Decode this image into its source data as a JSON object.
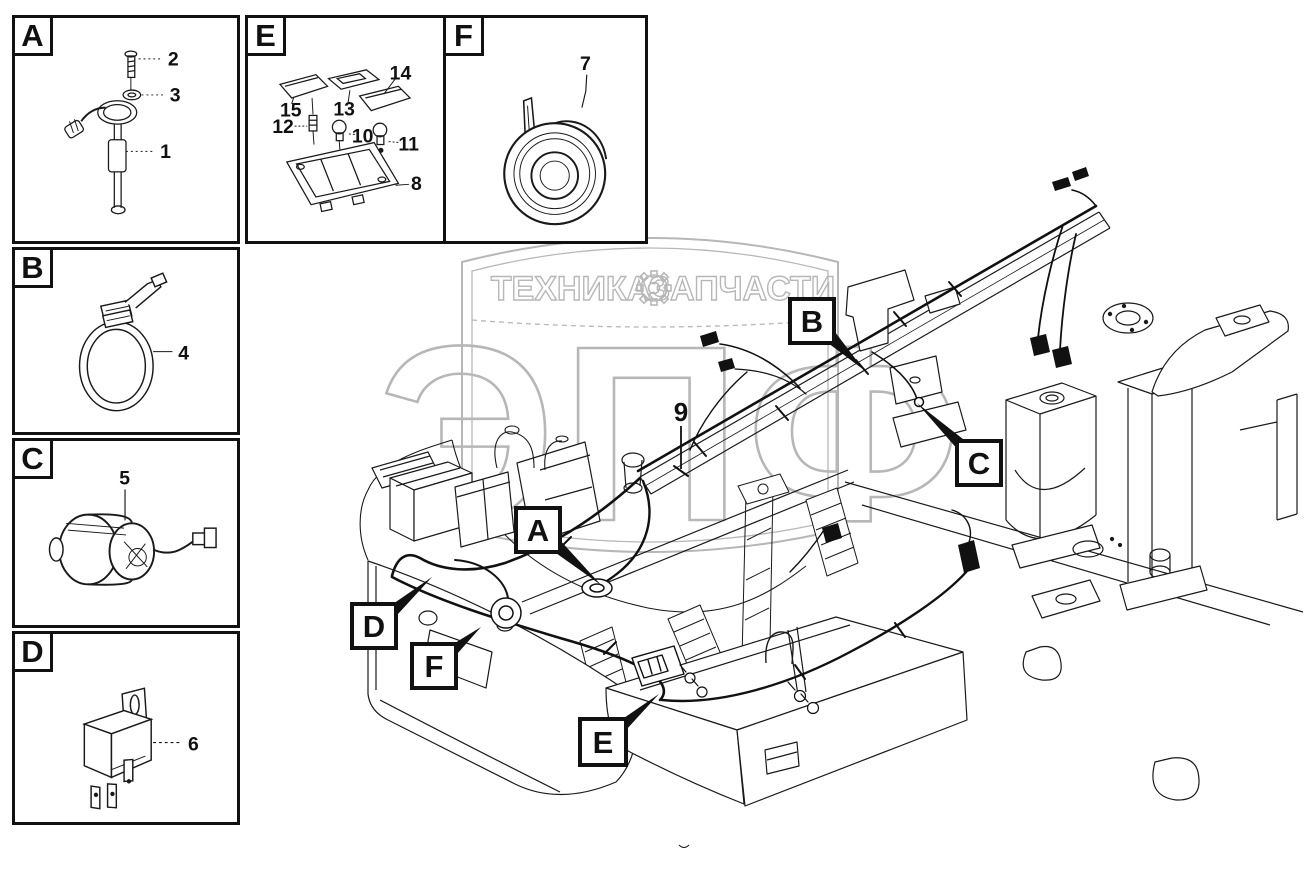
{
  "watermark": {
    "tagline_left": "ТЕХНИКА",
    "tagline_right": "ЗАПЧАСТИ",
    "logo_text": "ЭПФ",
    "color": "#b7b7b7"
  },
  "panels": {
    "a": {
      "letter": "A",
      "items": [
        "2",
        "3",
        "1"
      ]
    },
    "b": {
      "letter": "B",
      "items": [
        "4"
      ]
    },
    "c": {
      "letter": "C",
      "items": [
        "5"
      ]
    },
    "d": {
      "letter": "D",
      "items": [
        "6"
      ]
    },
    "e": {
      "letter": "E",
      "items": [
        "14",
        "15",
        "13",
        "12",
        "10",
        "11",
        "8"
      ]
    },
    "f": {
      "letter": "F",
      "items": [
        "7"
      ]
    }
  },
  "diagram": {
    "callouts": {
      "a": "A",
      "b": "B",
      "c": "C",
      "d": "D",
      "e": "E",
      "f": "F"
    },
    "wire_label": "9"
  },
  "colors": {
    "line": "#1a1a1a",
    "background": "#ffffff"
  }
}
